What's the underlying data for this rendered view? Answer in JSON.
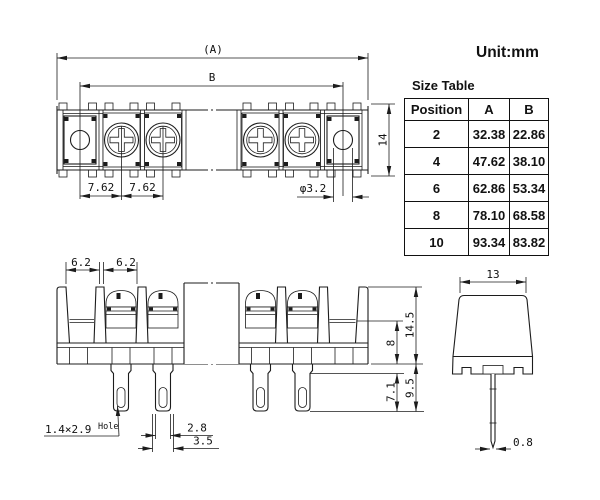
{
  "unit_label": "Unit:mm",
  "size_table": {
    "title": "Size Table",
    "columns": [
      "Position",
      "A",
      "B"
    ],
    "rows": [
      {
        "position": "2",
        "a": "32.38",
        "b": "22.86"
      },
      {
        "position": "4",
        "a": "47.62",
        "b": "38.10"
      },
      {
        "position": "6",
        "a": "62.86",
        "b": "53.34"
      },
      {
        "position": "8",
        "a": "78.10",
        "b": "68.58"
      },
      {
        "position": "10",
        "a": "93.34",
        "b": "83.82"
      }
    ]
  },
  "top_view": {
    "dim_overall_length": "(A)",
    "dim_mounting_span": "B",
    "dim_pitch_1": "7.62",
    "dim_pitch_2": "7.62",
    "dim_mounting_hole": "φ3.2",
    "dim_depth": "14"
  },
  "front_view": {
    "dim_segment_1": "6.2",
    "dim_segment_2": "6.2",
    "dim_overall_height": "14.5",
    "dim_body_height": "8",
    "dim_pin_length": "9.5",
    "dim_pin_narrow_length": "7.1",
    "pin_hole_note": "1.4×2.9",
    "pin_hole_note_word": "Hole",
    "dim_pin_width": "2.8",
    "dim_pin_base_width": "3.5"
  },
  "side_view": {
    "dim_width": "13",
    "dim_pin_thickness": "0.8"
  },
  "colors": {
    "line": "#1c1c1c",
    "text": "#111111",
    "background": "#ffffff"
  }
}
